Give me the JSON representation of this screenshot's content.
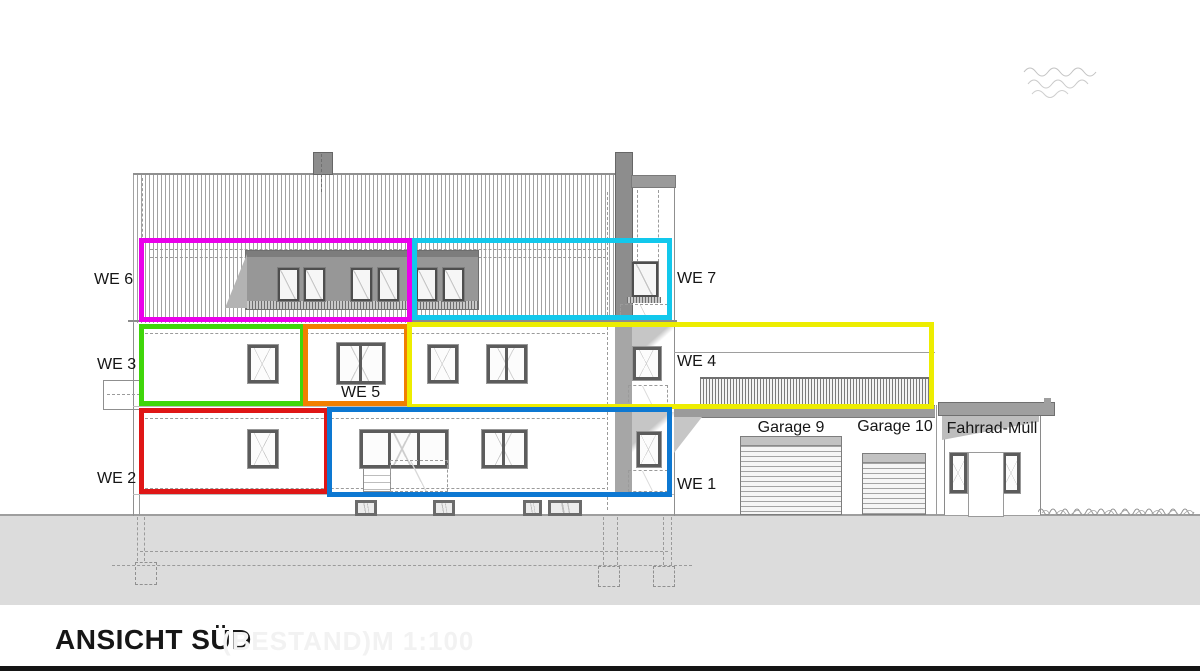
{
  "drawing": {
    "title": "ANSICHT SÜD",
    "status": "(BESTAND)",
    "scale": "M 1:100"
  },
  "units": {
    "we1": {
      "label": "WE 1",
      "color": "#0d78d2"
    },
    "we2": {
      "label": "WE 2",
      "color": "#df1616"
    },
    "we3": {
      "label": "WE 3",
      "color": "#3fd60a"
    },
    "we4": {
      "label": "WE 4",
      "color": "#eded00"
    },
    "we5": {
      "label": "WE 5",
      "color": "#f27f00"
    },
    "we6": {
      "label": "WE 6",
      "color": "#ea00ea"
    },
    "we7": {
      "label": "WE 7",
      "color": "#12c8ec"
    }
  },
  "annex": {
    "garage9": "Garage 9",
    "garage10": "Garage 10",
    "shed": "Fahrrad-Müll"
  }
}
